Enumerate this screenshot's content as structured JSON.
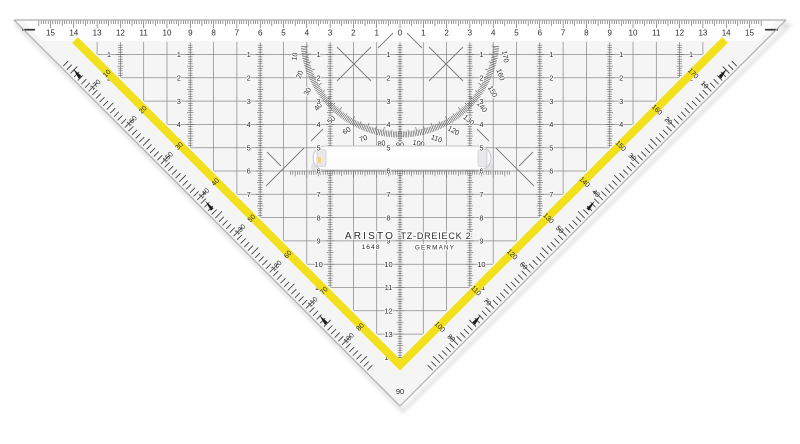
{
  "product": {
    "brand": "ARISTO",
    "model_number": "1648",
    "product_name": "TZ-DREIECK 2",
    "origin": "GERMANY",
    "vertex_angle_label": "90"
  },
  "top_ruler": {
    "unit": "cm",
    "numbers": [
      "15",
      "14",
      "13",
      "12",
      "11",
      "10",
      "9",
      "8",
      "7",
      "6",
      "5",
      "4",
      "3",
      "2",
      "1",
      "0",
      "1",
      "2",
      "3",
      "4",
      "5",
      "6",
      "7",
      "8",
      "9",
      "10",
      "11",
      "12",
      "13",
      "14",
      "15"
    ]
  },
  "grid": {
    "row_numbers": [
      "1",
      "2",
      "3",
      "4",
      "5",
      "6",
      "7",
      "8",
      "9",
      "10",
      "11",
      "12",
      "13",
      "14"
    ],
    "columns": [
      {
        "offset_cm": -12,
        "rows": 2
      },
      {
        "offset_cm": -9,
        "rows": 4
      },
      {
        "offset_cm": -6,
        "rows": 7
      },
      {
        "offset_cm": -3,
        "rows": 11
      },
      {
        "offset_cm": 0,
        "rows": 14
      },
      {
        "offset_cm": 3,
        "rows": 11
      },
      {
        "offset_cm": 6,
        "rows": 7
      },
      {
        "offset_cm": 9,
        "rows": 4
      },
      {
        "offset_cm": 12,
        "rows": 2
      }
    ]
  },
  "protractor": {
    "degree_labels": [
      "10",
      "20",
      "30",
      "40",
      "50",
      "60",
      "70",
      "80",
      "90",
      "100",
      "110",
      "120",
      "130",
      "140",
      "150",
      "160",
      "170"
    ]
  },
  "edge_scales": {
    "left": {
      "stripe_labels": [
        "10",
        "20",
        "30",
        "40",
        "50",
        "60",
        "70",
        "80"
      ],
      "band_labels": [
        "170",
        "160",
        "150",
        "140",
        "130",
        "120",
        "110",
        "100"
      ]
    },
    "right": {
      "stripe_labels": [
        "170",
        "160",
        "150",
        "140",
        "130",
        "120",
        "110",
        "100"
      ],
      "band_labels": [
        "10",
        "20",
        "30",
        "40",
        "50",
        "60",
        "70",
        "80"
      ]
    }
  },
  "colors": {
    "accent_yellow": "#f2e01c",
    "ink": "#2a2a2a",
    "grid_line": "#8c8c8c",
    "scale_tick": "#555555",
    "acrylic": "#f5f5f6",
    "outline": "#aeaeb2"
  }
}
